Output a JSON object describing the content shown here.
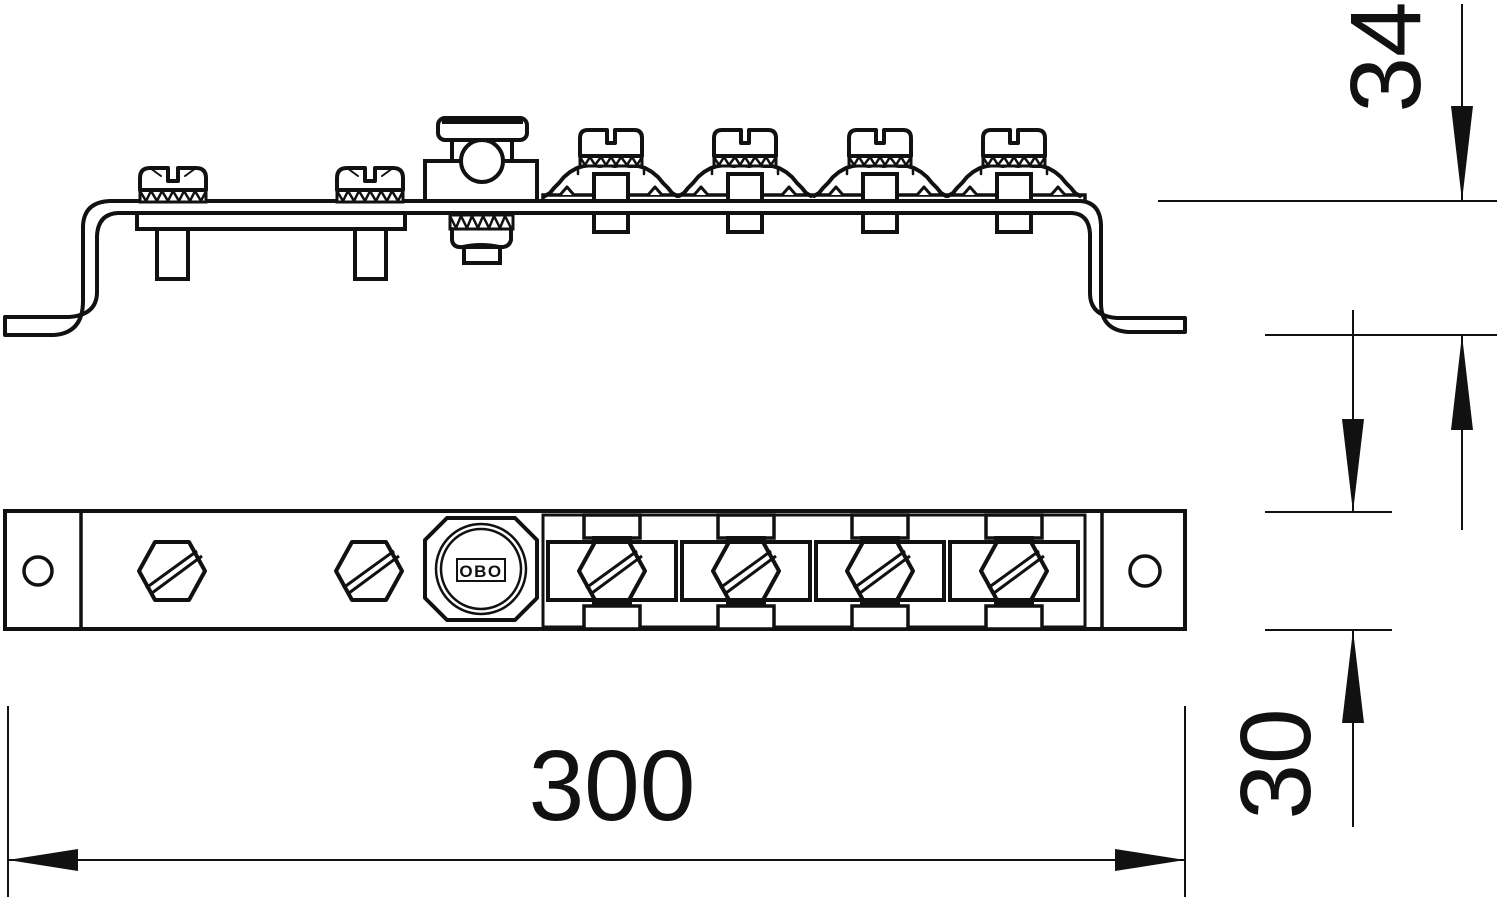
{
  "drawing": {
    "background_color": "#ffffff",
    "line_color": "#111111",
    "description_kind": "two-view technical line drawing of an equipotential bonding busbar",
    "logo_text": "OBO",
    "dimensions": {
      "overall_length": {
        "value": "300",
        "orientation": "horizontal"
      },
      "overall_height": {
        "value": "34",
        "orientation": "vertical"
      },
      "bar_width": {
        "value": "30",
        "orientation": "vertical"
      }
    }
  }
}
